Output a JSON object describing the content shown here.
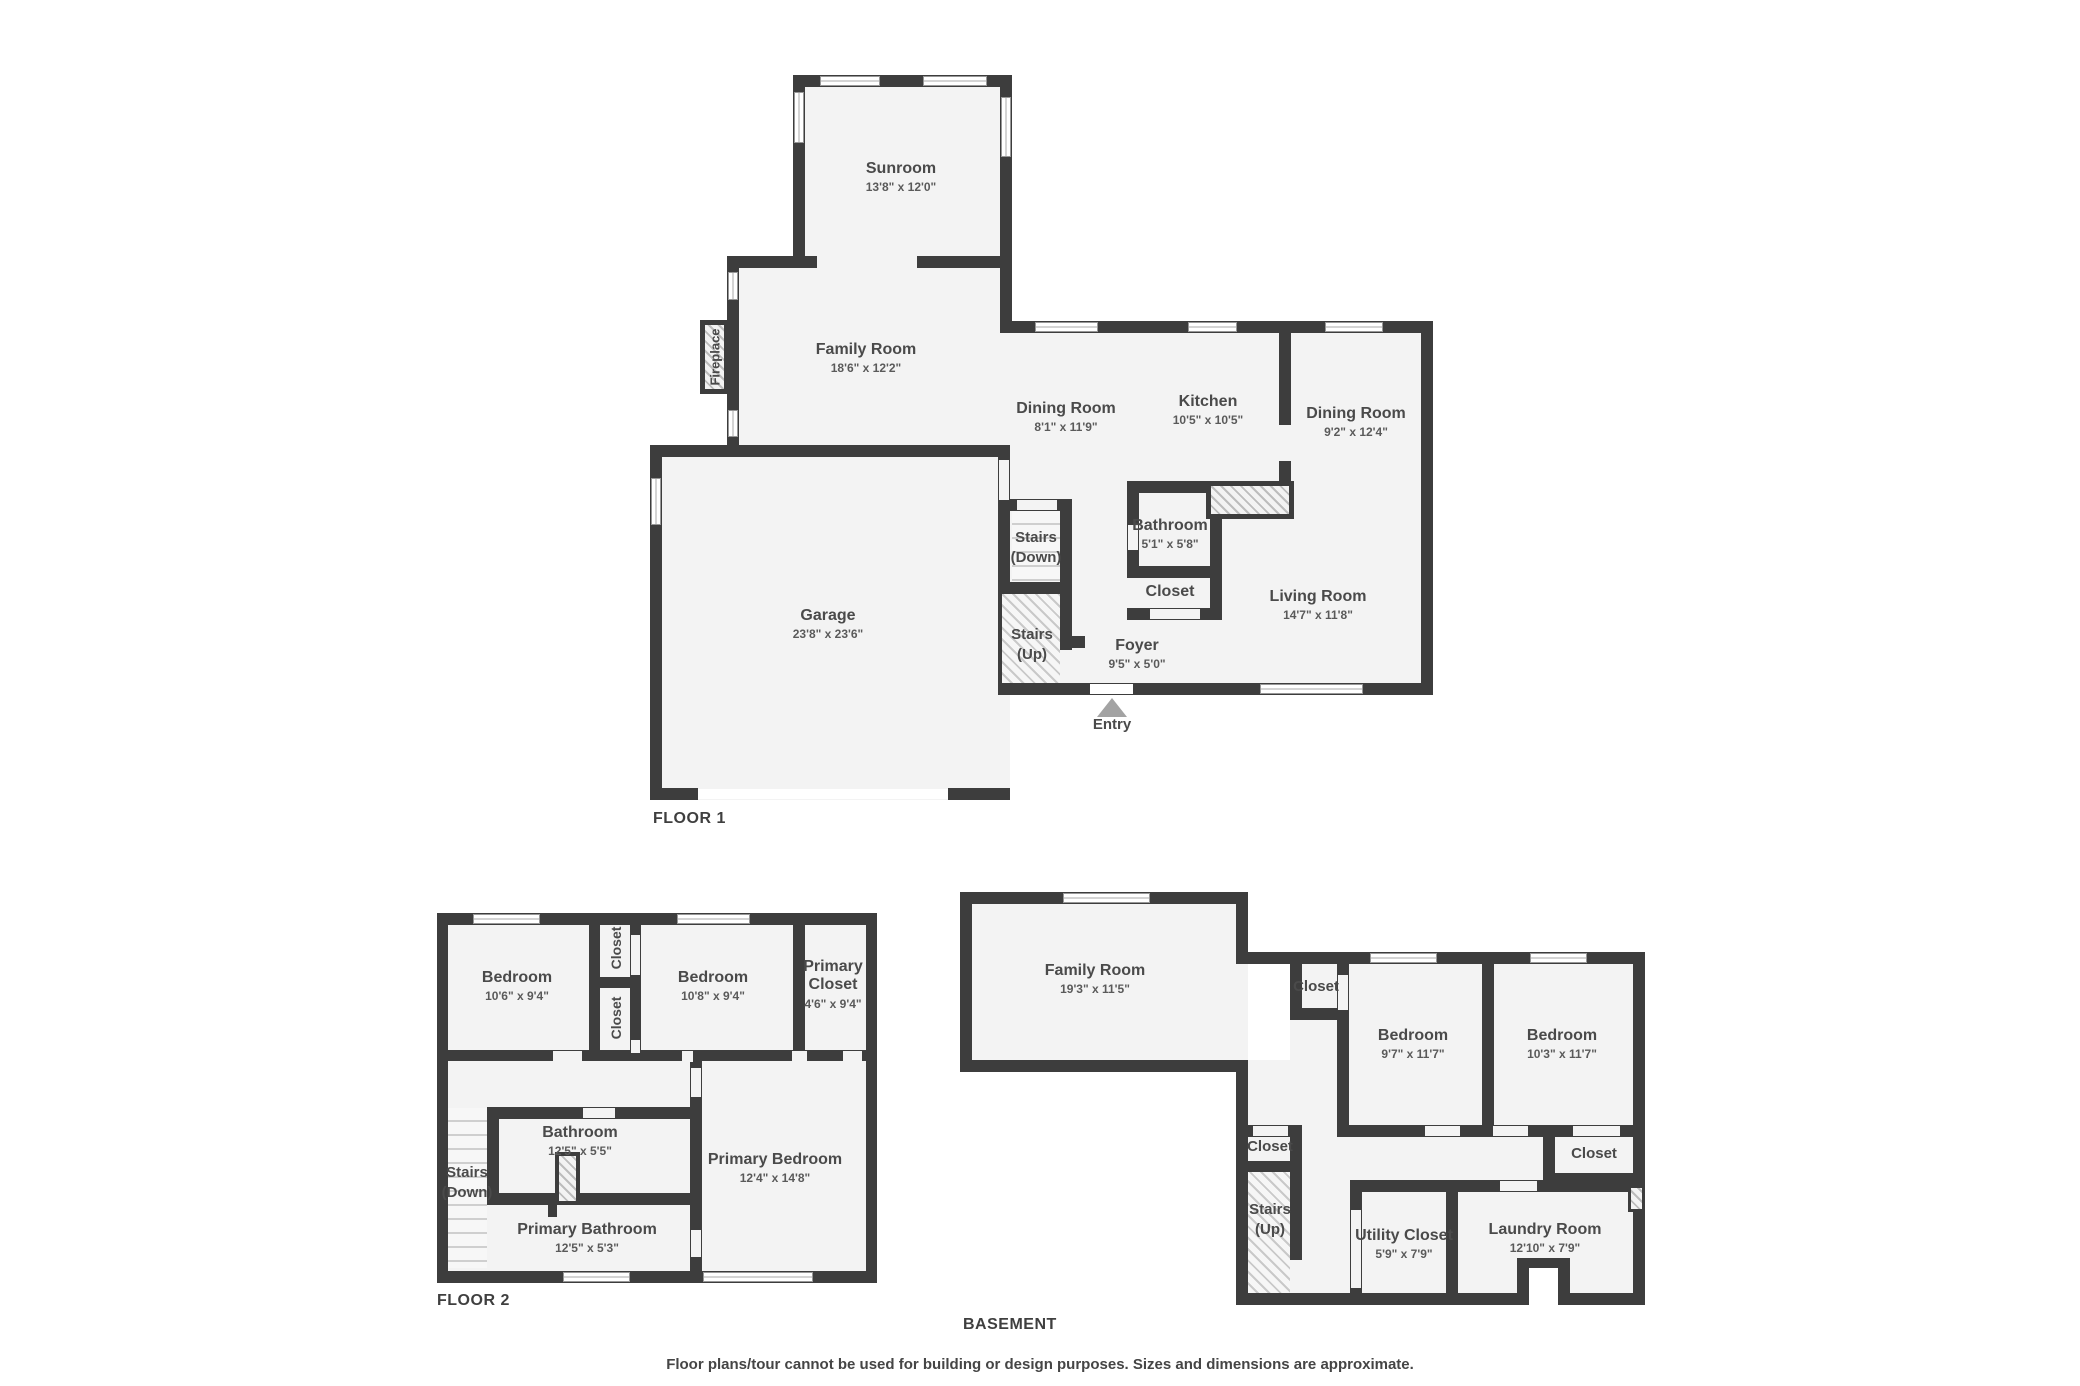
{
  "floor1": {
    "title": "FLOOR 1",
    "entry_label": "Entry",
    "fireplace_label": "Fireplace",
    "rooms": {
      "sunroom": {
        "name": "Sunroom",
        "dims": "13'8\" x 12'0\""
      },
      "family": {
        "name": "Family Room",
        "dims": "18'6\" x 12'2\""
      },
      "dining1": {
        "name": "Dining Room",
        "dims": "8'1\" x 11'9\""
      },
      "kitchen": {
        "name": "Kitchen",
        "dims": "10'5\" x 10'5\""
      },
      "dining2": {
        "name": "Dining Room",
        "dims": "9'2\" x 12'4\""
      },
      "bathroom": {
        "name": "Bathroom",
        "dims": "5'1\" x 5'8\""
      },
      "closet": {
        "name": "Closet"
      },
      "living": {
        "name": "Living Room",
        "dims": "14'7\" x 11'8\""
      },
      "garage": {
        "name": "Garage",
        "dims": "23'8\" x 23'6\""
      },
      "foyer": {
        "name": "Foyer",
        "dims": "9'5\" x 5'0\""
      },
      "stairs_down": {
        "name": "Stairs",
        "name2": "(Down)"
      },
      "stairs_up": {
        "name": "Stairs",
        "name2": "(Up)"
      }
    }
  },
  "floor2": {
    "title": "FLOOR 2",
    "rooms": {
      "bedroom1": {
        "name": "Bedroom",
        "dims": "10'6\" x 9'4\""
      },
      "closet_a": {
        "name": "Closet"
      },
      "closet_b": {
        "name": "Closet"
      },
      "bedroom2": {
        "name": "Bedroom",
        "dims": "10'8\" x 9'4\""
      },
      "primary_closet": {
        "name": "Primary Closet",
        "dims": "4'6\" x 9'4\""
      },
      "bathroom": {
        "name": "Bathroom",
        "dims": "12'5\" x 5'5\""
      },
      "primary_bathroom": {
        "name": "Primary Bathroom",
        "dims": "12'5\" x 5'3\""
      },
      "primary_bedroom": {
        "name": "Primary Bedroom",
        "dims": "12'4\" x 14'8\""
      },
      "stairs_down": {
        "name": "Stairs",
        "name2": "(Down)"
      }
    }
  },
  "basement": {
    "title": "BASEMENT",
    "rooms": {
      "family": {
        "name": "Family Room",
        "dims": "19'3\" x 11'5\""
      },
      "closet_top": {
        "name": "Closet"
      },
      "bedroom1": {
        "name": "Bedroom",
        "dims": "9'7\" x 11'7\""
      },
      "bedroom2": {
        "name": "Bedroom",
        "dims": "10'3\" x 11'7\""
      },
      "closet_left": {
        "name": "Closet"
      },
      "closet_right": {
        "name": "Closet"
      },
      "stairs_up": {
        "name": "Stairs",
        "name2": "(Up)"
      },
      "utility": {
        "name": "Utility Closet",
        "dims": "5'9\" x 7'9\""
      },
      "laundry": {
        "name": "Laundry Room",
        "dims": "12'10\" x 7'9\""
      }
    }
  },
  "footer": {
    "disclaimer": "Floor plans/tour cannot be used for building or design purposes. Sizes and dimensions are approximate."
  },
  "colors": {
    "wall": "#3d3d3d",
    "room_fill": "#f3f3f3",
    "text": "#4a4a4a",
    "entry_arrow": "#a3a3a3"
  }
}
